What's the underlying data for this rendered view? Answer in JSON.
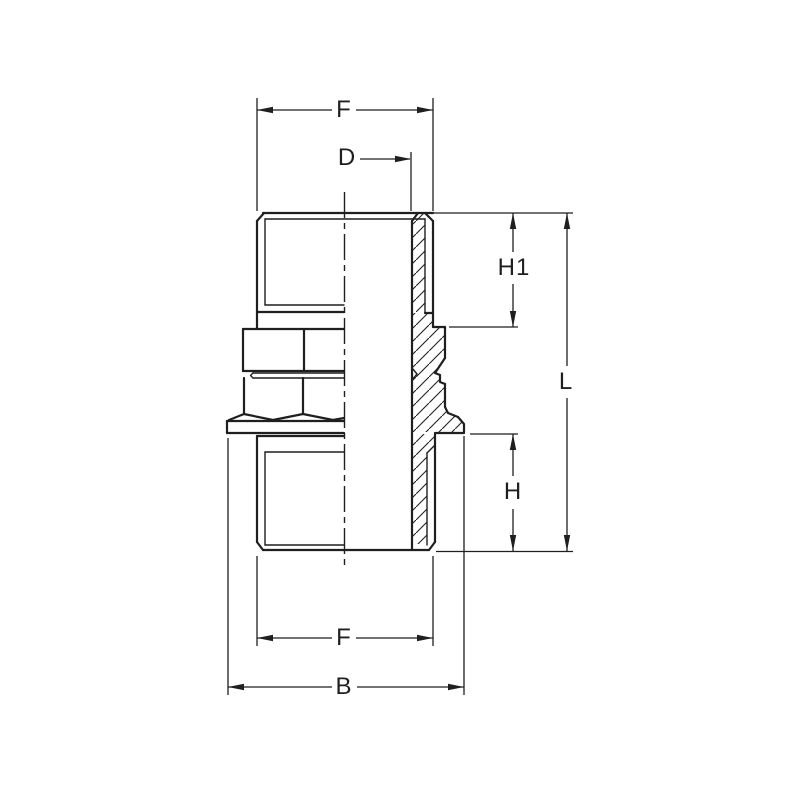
{
  "drawing": {
    "kind": "technical-dimension-drawing",
    "colors": {
      "background": "#ffffff",
      "line": "#1f1f1f"
    },
    "dimension_labels": {
      "f_top": "F",
      "d": "D",
      "h1": "H1",
      "l": "L",
      "h": "H",
      "f_bottom": "F",
      "b": "B"
    }
  }
}
